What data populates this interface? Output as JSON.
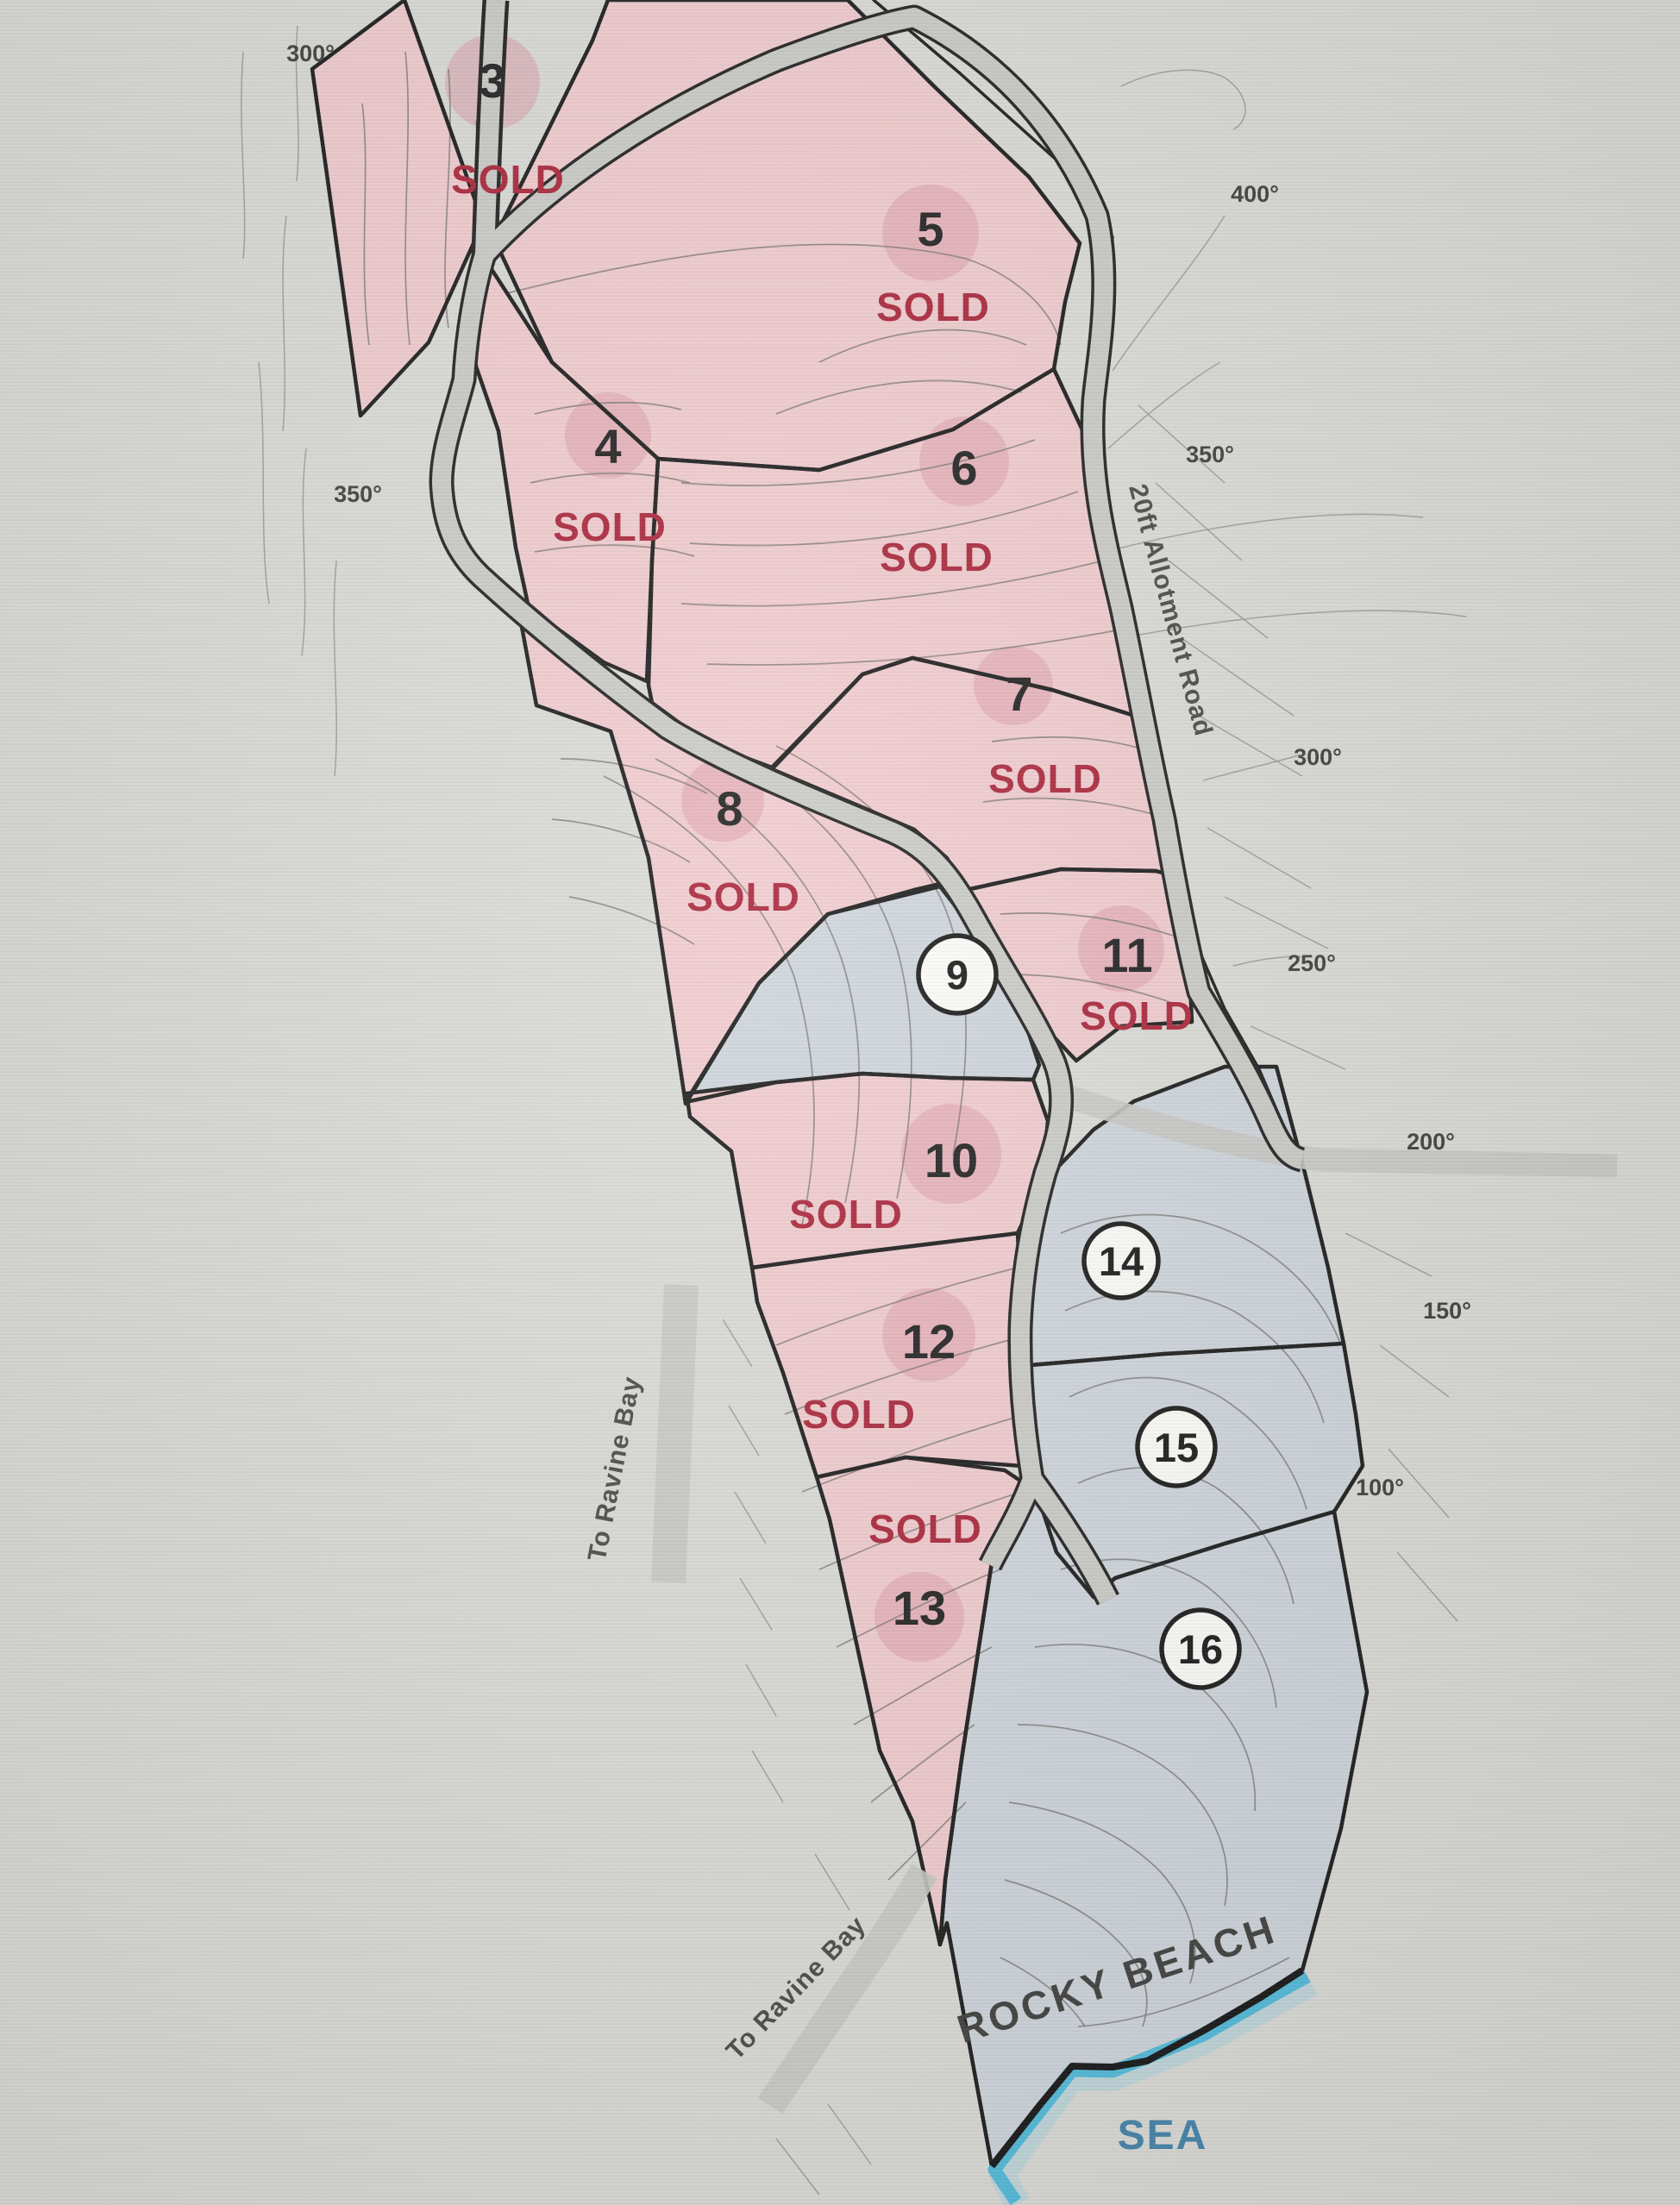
{
  "map": {
    "title_hint": "coastal allotment plot plan",
    "sold_text": "SOLD",
    "colors": {
      "sold_text": "#a82136",
      "plot_sold_fill": "#f0cacd",
      "plot_available_fill": "#cdd4da",
      "sea_text": "#3f80a8",
      "coast_water": "#43b7d9",
      "background": "#d9d9d5"
    },
    "plots": [
      {
        "id": "3",
        "number": "3",
        "status": "sold",
        "sold_label": "SOLD"
      },
      {
        "id": "4",
        "number": "4",
        "status": "sold",
        "sold_label": "SOLD"
      },
      {
        "id": "5",
        "number": "5",
        "status": "sold",
        "sold_label": "SOLD"
      },
      {
        "id": "6",
        "number": "6",
        "status": "sold",
        "sold_label": "SOLD"
      },
      {
        "id": "7",
        "number": "7",
        "status": "sold",
        "sold_label": "SOLD"
      },
      {
        "id": "8",
        "number": "8",
        "status": "sold",
        "sold_label": "SOLD"
      },
      {
        "id": "9",
        "number": "9",
        "status": "available"
      },
      {
        "id": "10",
        "number": "10",
        "status": "sold",
        "sold_label": "SOLD"
      },
      {
        "id": "11",
        "number": "11",
        "status": "sold",
        "sold_label": "SOLD"
      },
      {
        "id": "12",
        "number": "12",
        "status": "sold",
        "sold_label": "SOLD"
      },
      {
        "id": "13",
        "number": "13",
        "status": "sold",
        "sold_label": "SOLD"
      },
      {
        "id": "14",
        "number": "14",
        "status": "available"
      },
      {
        "id": "15",
        "number": "15",
        "status": "available"
      },
      {
        "id": "16",
        "number": "16",
        "status": "available"
      }
    ],
    "elevations": [
      {
        "text": "300°"
      },
      {
        "text": "350°"
      },
      {
        "text": "400°"
      },
      {
        "text": "350°"
      },
      {
        "text": "300°"
      },
      {
        "text": "250°"
      },
      {
        "text": "200°"
      },
      {
        "text": "150°"
      },
      {
        "text": "100°"
      }
    ],
    "road_labels": {
      "allotment_road": "20ft Allotment Road",
      "ravine_left": "To Ravine Bay",
      "ravine_bottom": "To Ravine Bay"
    },
    "region_labels": {
      "beach": "ROCKY BEACH",
      "sea": "SEA"
    }
  }
}
